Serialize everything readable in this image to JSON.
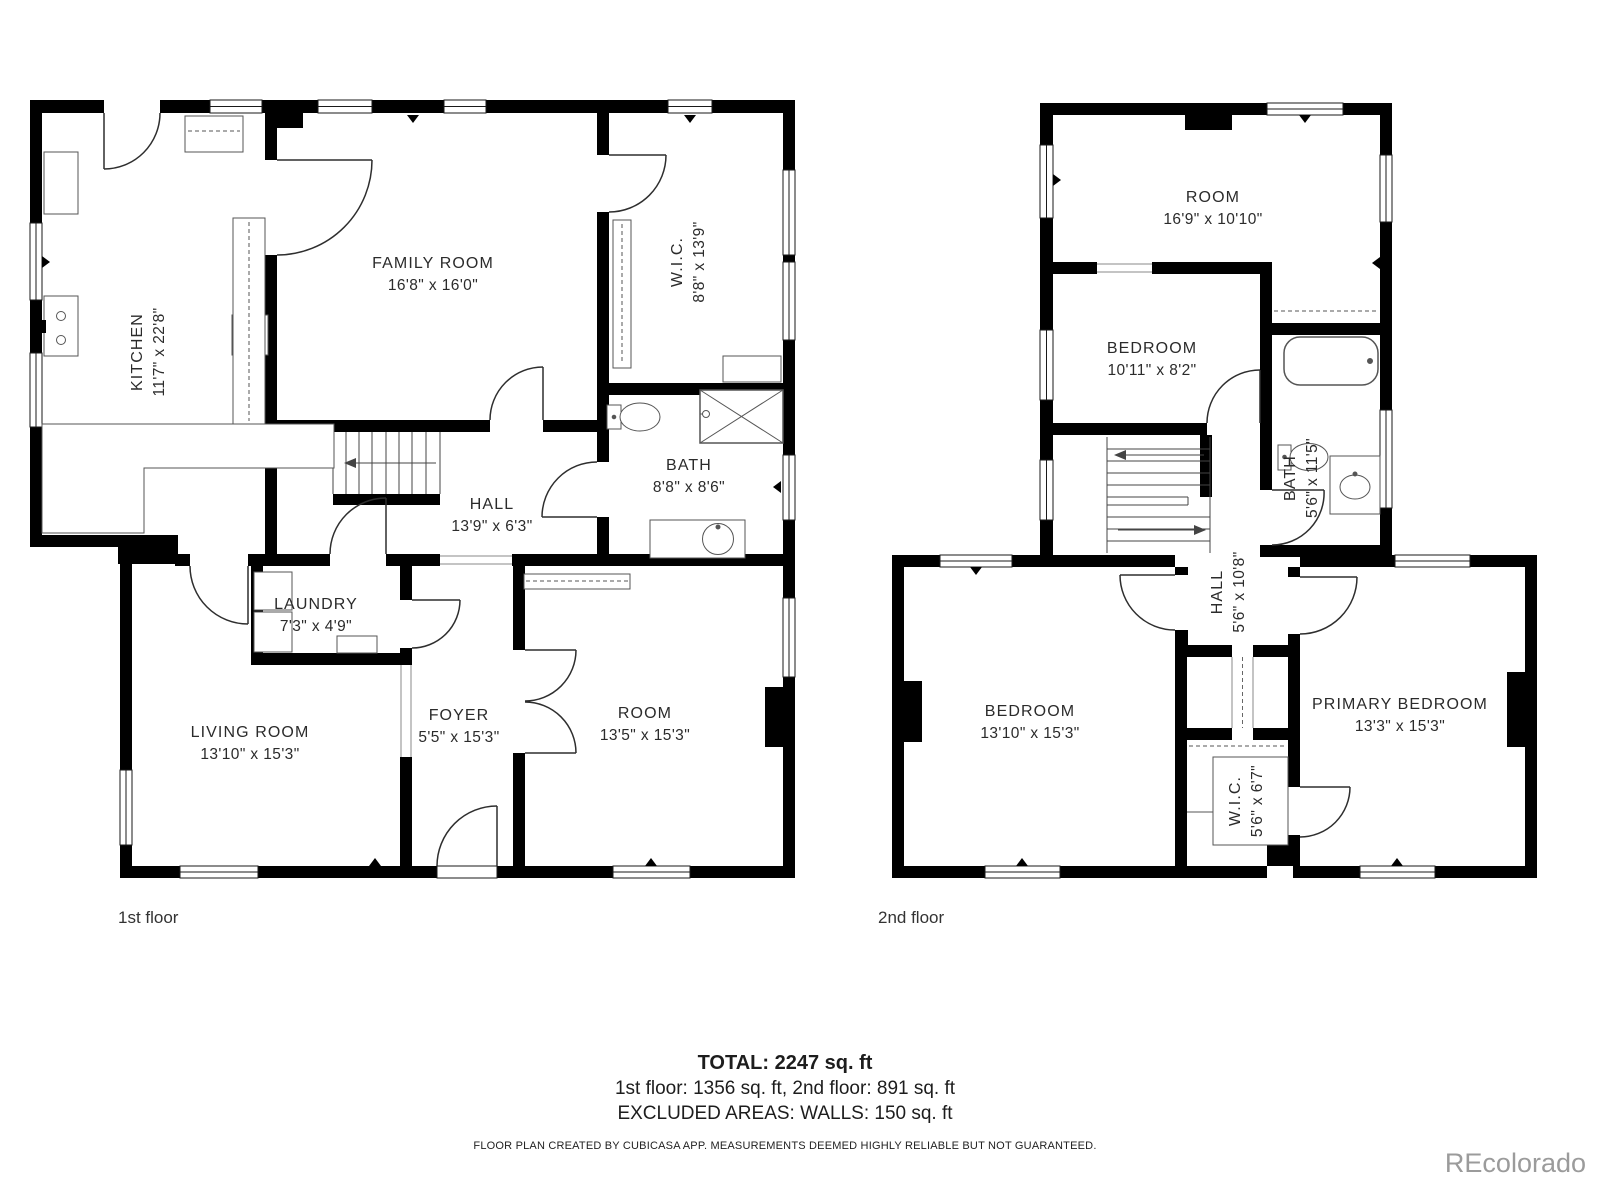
{
  "colors": {
    "wall": "#000000",
    "label_text": "#2b2b2b",
    "caption_text": "#333333",
    "watermark_text": "#9b9b9b"
  },
  "floors": {
    "first": {
      "label": "1st floor",
      "rooms": [
        {
          "id": "kitchen",
          "name": "KITCHEN",
          "dims": "11'7\" x 22'8\""
        },
        {
          "id": "family-room",
          "name": "FAMILY ROOM",
          "dims": "16'8\" x 16'0\""
        },
        {
          "id": "wic",
          "name": "W.I.C.",
          "dims": "8'8\" x 13'9\""
        },
        {
          "id": "bath",
          "name": "BATH",
          "dims": "8'8\" x 8'6\""
        },
        {
          "id": "hall",
          "name": "HALL",
          "dims": "13'9\" x 6'3\""
        },
        {
          "id": "laundry",
          "name": "LAUNDRY",
          "dims": "7'3\" x 4'9\""
        },
        {
          "id": "living-room",
          "name": "LIVING ROOM",
          "dims": "13'10\" x 15'3\""
        },
        {
          "id": "foyer",
          "name": "FOYER",
          "dims": "5'5\" x 15'3\""
        },
        {
          "id": "room",
          "name": "ROOM",
          "dims": "13'5\" x 15'3\""
        }
      ]
    },
    "second": {
      "label": "2nd floor",
      "rooms": [
        {
          "id": "room",
          "name": "ROOM",
          "dims": "16'9\" x 10'10\""
        },
        {
          "id": "bedroom-small",
          "name": "BEDROOM",
          "dims": "10'11\" x 8'2\""
        },
        {
          "id": "bath",
          "name": "BATH",
          "dims": "5'6\" x 11'5\""
        },
        {
          "id": "hall",
          "name": "HALL",
          "dims": "5'6\" x 10'8\""
        },
        {
          "id": "bedroom",
          "name": "BEDROOM",
          "dims": "13'10\" x 15'3\""
        },
        {
          "id": "primary-bedroom",
          "name": "PRIMARY BEDROOM",
          "dims": "13'3\" x 15'3\""
        },
        {
          "id": "wic",
          "name": "W.I.C.",
          "dims": "5'6\" x 6'7\""
        }
      ]
    }
  },
  "summary": {
    "total": "TOTAL: 2247 sq. ft",
    "floors_line": "1st floor: 1356 sq. ft, 2nd floor: 891 sq. ft",
    "excluded_line": "EXCLUDED AREAS: WALLS: 150 sq. ft",
    "disclaimer": "FLOOR PLAN CREATED BY CUBICASA APP. MEASUREMENTS DEEMED HIGHLY RELIABLE BUT NOT GUARANTEED.",
    "watermark": "REcolorado"
  }
}
